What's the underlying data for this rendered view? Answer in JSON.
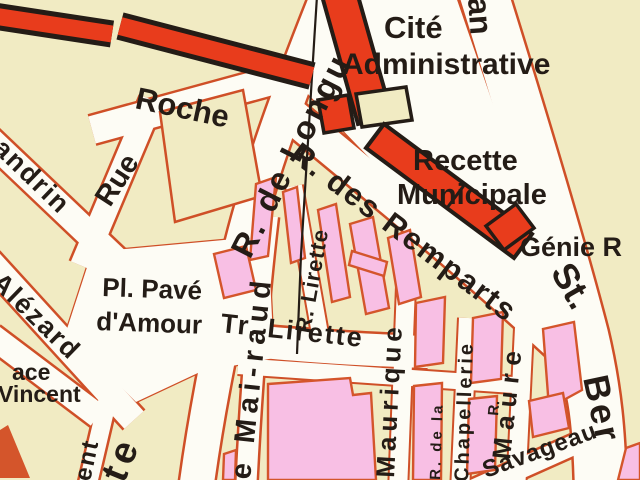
{
  "map": {
    "description": "Scanned French city street-map detail",
    "labels": {
      "cite_line1": "Cité",
      "cite_line2": "Administrative",
      "recette_line1": "Recette",
      "recette_line2": "Municipale",
      "genie": "Génie R",
      "roche": "Roche",
      "rue": "Rue",
      "longu": "R. de Longu",
      "remparts": "R. des Remparts",
      "andrin": "andrin",
      "alezard": "Alézard",
      "vincent_line1": "ace",
      "vincent_line2": "Vincent",
      "pave_line1": "Pl. Pavé",
      "pave_line2": "d'Amour",
      "tr_lirette": "Tr. Lirette",
      "r_lirette": "R. Lirette",
      "mairaud": "e Mai-raud",
      "maurique": "Maurique",
      "chapellerie_line1": "R. de la",
      "chapellerie_line2": "Chapellerie",
      "maure_prefix": "R.",
      "maure": "Maure",
      "savageau": "Savageau",
      "st_bernard_line1": "St.",
      "st_bernard_line2": "Ber",
      "partial_top_right": "an",
      "partial_ent": "ent",
      "partial_te": "te"
    },
    "colors": {
      "background": "#f1ebc3",
      "road_fill": "#fdfcf5",
      "road_edge": "#cf4f27",
      "block_pink": "#f8bfe4",
      "building_red": "#e83c1c",
      "outline_black": "#241c16"
    }
  }
}
